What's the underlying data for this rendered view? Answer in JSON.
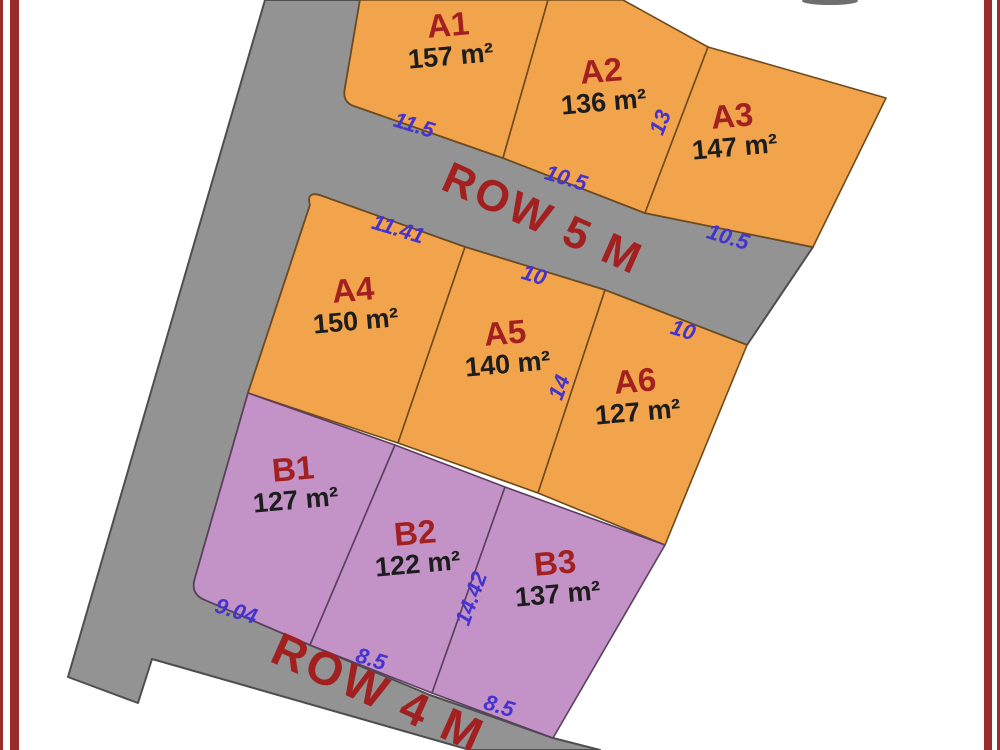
{
  "map_title": "Land subdivision plot plan",
  "plots": [
    {
      "name": "A1",
      "area": "157 m²"
    },
    {
      "name": "A2",
      "area": "136 m²"
    },
    {
      "name": "A3",
      "area": "147 m²"
    },
    {
      "name": "A4",
      "area": "150 m²"
    },
    {
      "name": "A5",
      "area": "140 m²"
    },
    {
      "name": "A6",
      "area": "127 m²"
    },
    {
      "name": "B1",
      "area": "127 m²"
    },
    {
      "name": "B2",
      "area": "122 m²"
    },
    {
      "name": "B3",
      "area": "137 m²"
    }
  ],
  "roads": {
    "row5_label": "ROW 5 M",
    "row4_label": "ROW 4 M"
  },
  "dimensions": {
    "a1_frontage": "11.5",
    "a2_frontage": "10.5",
    "a2_a3_side": "13",
    "a3_frontage": "10.5",
    "a4_frontage": "11.41",
    "a5_frontage": "10",
    "a6_frontage": "10",
    "a5_a6_side": "14",
    "b1_frontage": "9.04",
    "b2_frontage": "8.5",
    "b2_b3_side": "14.42",
    "b3_frontage": "8.5"
  },
  "colors": {
    "plot_a_fill": "#F2A44C",
    "plot_a_stroke": "#6e4a1d",
    "plot_b_fill": "#C393C7",
    "plot_b_stroke": "#5c3f5e",
    "road_fill": "#939393",
    "road_stroke": "#4e4e4e",
    "plot_name_text": "#A32020",
    "area_text": "#1d1d1d",
    "dimension_text": "#4433CC",
    "road_label_text": "#A32020",
    "page_border": "#9b2c2c"
  }
}
